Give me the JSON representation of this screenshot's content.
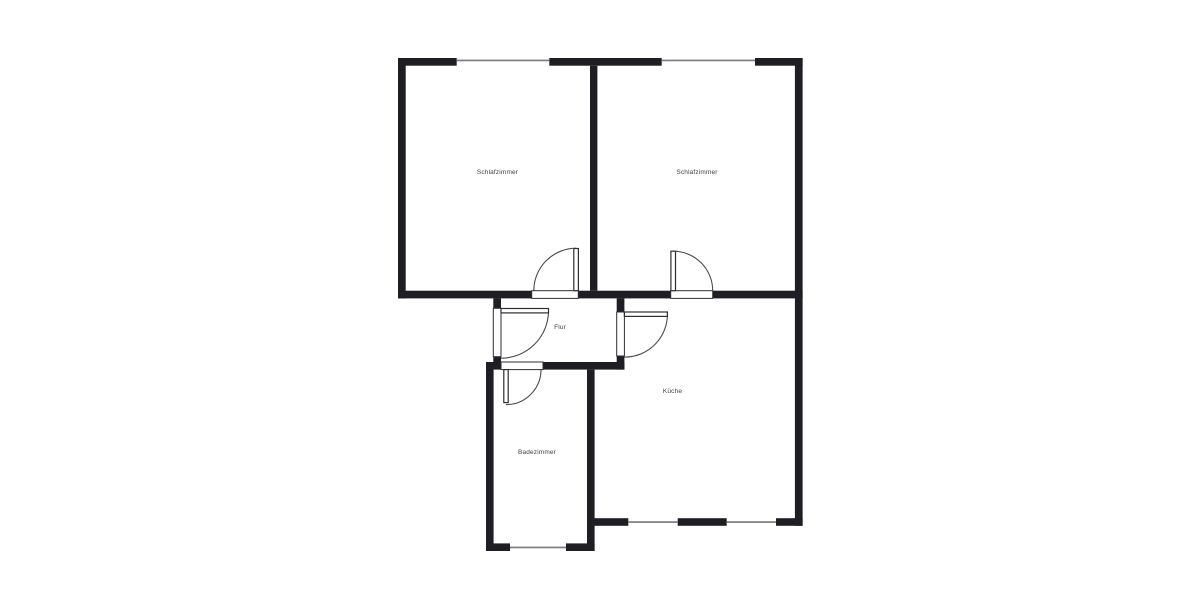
{
  "floor_plan": {
    "type": "2d-floor-plan",
    "colors": {
      "background": "#ffffff",
      "wall": "#1e1e24",
      "window_line": "#7d7d82",
      "door_outline": "#2e2e33",
      "door_arc": "#4a4a4f",
      "door_fill": "#ffffff",
      "label": "#3f3f44"
    },
    "rooms": [
      {
        "label": "Schlafzimmer"
      },
      {
        "label": "Schlafzimmer"
      },
      {
        "label": "Flur"
      },
      {
        "label": "Küche"
      },
      {
        "label": "Badezimmer"
      }
    ]
  }
}
